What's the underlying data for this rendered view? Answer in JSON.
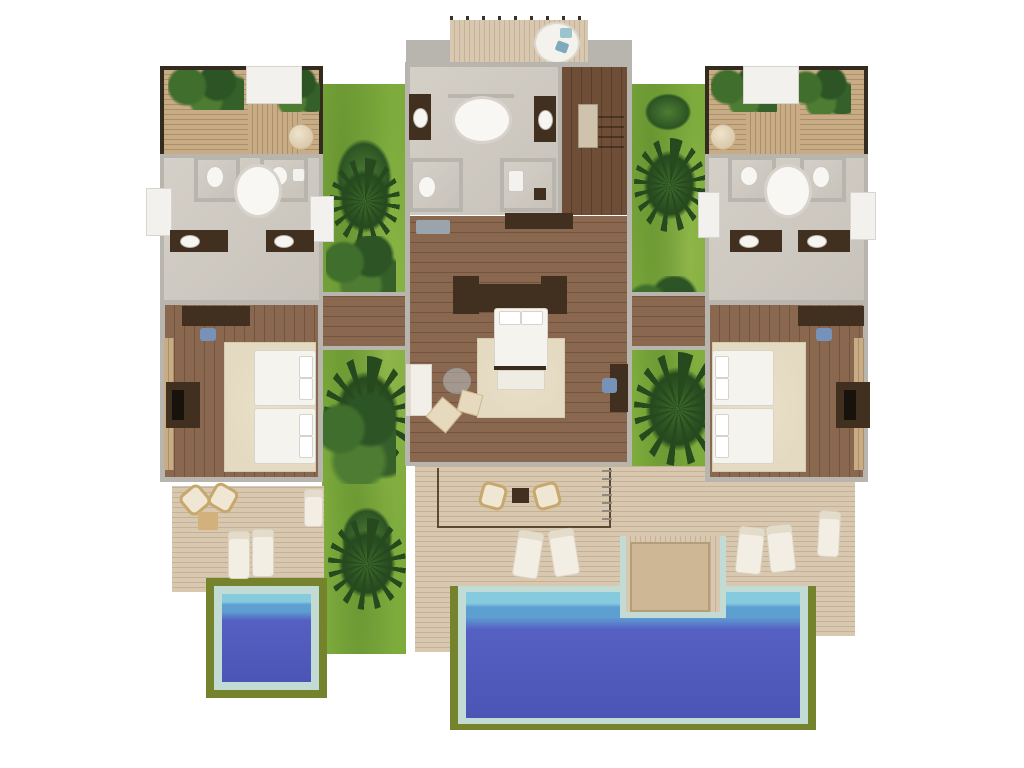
{
  "image_type": "3d-top-down-floor-plan-render",
  "palette": {
    "wall": "#b8b4ae",
    "wall-light": "#e2dfda",
    "dark-frame": "#342b1f",
    "bath-floor": "#d0cbc3",
    "wood-floor": "#8a6850",
    "wood-floor-dark": "#6f4e38",
    "deck-wood": "#d8c8b0",
    "slat-wood": "#c8ac85",
    "furniture-dark": "#41301f",
    "rug-beige": "#e4dac1",
    "bed-white": "#f5f3ed",
    "grass-green": "#7dab3c",
    "palm-dark": "#26491e",
    "palm-mid": "#3d6b2c",
    "pool-lawn": "#75832d",
    "pool-border": "#c2dbd4",
    "pool-deep": "#5560c2",
    "pool-mid": "#5e9fd2",
    "pool-light": "#86cade",
    "cushion-blue": "#7792b8",
    "white-panel": "#f2f1ee"
  },
  "scene": {
    "wings": [
      "left-guest-wing",
      "master-wing",
      "right-guest-wing"
    ],
    "rooms": [
      "outdoor-bathroom-left",
      "bathroom-left",
      "bedroom-left",
      "master-bathroom",
      "stair-room",
      "master-bedroom",
      "outdoor-bathroom-right",
      "bathroom-right",
      "bedroom-right"
    ],
    "pools": [
      {
        "name": "plunge-pool",
        "shape": "square",
        "position": "bottom-left"
      },
      {
        "name": "main-pool",
        "shape": "notched-rectangle",
        "position": "bottom-center"
      }
    ],
    "furniture": {
      "twin_beds": 4,
      "king_beds": 1,
      "bathtubs": 3,
      "toilets": 5,
      "vanities": 6,
      "sun_loungers": 8,
      "armchairs": 4,
      "ottomans": 2,
      "sofas": 1,
      "round_daybeds": 1,
      "pool_platform_daybeds": 1
    },
    "landscape": {
      "garden_strips": 2,
      "palm_clusters": 8,
      "lawn_pool_surrounds": 2
    }
  }
}
